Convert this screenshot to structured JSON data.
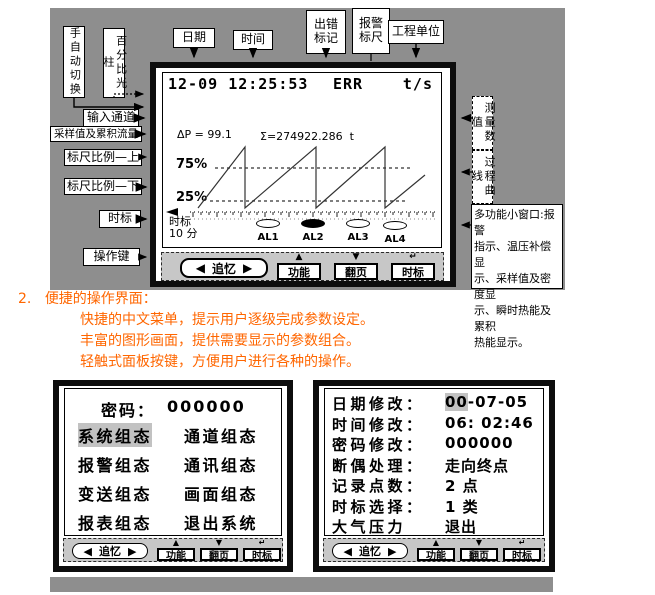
{
  "colors": {
    "panel_gray": "#8e8e8e",
    "keybar_gray": "#c7c7c7",
    "highlight_gray": "#c2c2c2",
    "accent_orange": "#ff6600",
    "ink": "#000000"
  },
  "callouts": {
    "manual_auto": "手自动切换",
    "percent_bar": "百分比光柱",
    "date": "日期",
    "time": "时间",
    "error_mark": "出错\n标记",
    "alarm_ruler": "报警\n标尺",
    "eng_unit": "工程单位",
    "input_channel": "输入通道",
    "sample_value": "采样值及累积流量",
    "scale_upper": "标尺比例—上",
    "scale_lower": "标尺比例—下",
    "time_mark": "时标",
    "op_keys": "操作键",
    "measured_value": "测量数值",
    "process_curve": "过程曲线",
    "multi_window_lines": [
      "多功能小窗口:报警",
      "指示、温压补偿显",
      "示、采样值及密度显",
      "示、瞬时热能及累积",
      "热能显示。"
    ]
  },
  "main_screen": {
    "header": {
      "date": "12-09",
      "time": "12:25:53",
      "err": "ERR",
      "unit": "t/s"
    },
    "dp_label": "ΔP = 99.1",
    "sigma_label": "Σ=274922.286",
    "sigma_unit": "t",
    "upper_pct": "75%",
    "lower_pct": "25%",
    "time_mark_label": "时标",
    "time_mark_value": "10 分",
    "alarms": [
      {
        "label": "AL1",
        "filled": false,
        "cx": 105,
        "cy": 150
      },
      {
        "label": "AL2",
        "filled": true,
        "cx": 150,
        "cy": 150
      },
      {
        "label": "AL3",
        "filled": false,
        "cx": 195,
        "cy": 150
      },
      {
        "label": "AL4",
        "filled": false,
        "cx": 232,
        "cy": 152
      }
    ],
    "waveform": {
      "points": [
        [
          35,
          135
        ],
        [
          82,
          74
        ],
        [
          82,
          135
        ],
        [
          153,
          74
        ],
        [
          153,
          135
        ],
        [
          222,
          74
        ],
        [
          222,
          135
        ],
        [
          262,
          102
        ]
      ],
      "upper_line": {
        "y": 95,
        "x1": 52,
        "x2": 247
      },
      "lower_line": {
        "y": 128,
        "x1": 47,
        "x2": 243
      },
      "axis": {
        "y": 139,
        "x1": 27,
        "x2": 274,
        "tick_step": 8,
        "tick_h": 5
      }
    }
  },
  "keybar": {
    "recall_left": "◀",
    "recall_label": "追忆",
    "recall_right": "▶",
    "keys": [
      {
        "glyph": "▲",
        "label": "功能"
      },
      {
        "glyph": "▼",
        "label": "翻页"
      },
      {
        "glyph": "↵",
        "label": "时标"
      }
    ]
  },
  "section": {
    "number": "2.",
    "title": "便捷的操作界面：",
    "lines": [
      "快捷的中文菜单，提示用户逐级完成参数设定。",
      "丰富的图形画面，提供需要显示的参数组合。",
      "轻触式面板按键，方便用户进行各种的操作。"
    ]
  },
  "menu_screen": {
    "password_label": "密码：",
    "password_value": "000000",
    "highlight": "系统组态",
    "items": [
      {
        "left": "系统组态",
        "right": "通道组态"
      },
      {
        "left": "报警组态",
        "right": "通讯组态"
      },
      {
        "left": "变送组态",
        "right": "画面组态"
      },
      {
        "left": "报表组态",
        "right": "退出系统"
      }
    ]
  },
  "config_screen": {
    "rows": [
      {
        "label": "日期修改：",
        "value_hl": "00",
        "value": "-07-05"
      },
      {
        "label": "时间修改：",
        "value_hl": "",
        "value": "06: 02:46"
      },
      {
        "label": "密码修改：",
        "value_hl": "",
        "value": "000000"
      },
      {
        "label": "断偶处理：",
        "value_hl": "",
        "value": "走向终点"
      },
      {
        "label": "记录点数：",
        "value_hl": "",
        "value": "2 点"
      },
      {
        "label": "时标选择：",
        "value_hl": "",
        "value": "1 类"
      },
      {
        "label": "大气压力",
        "value_hl": "",
        "value": "退出"
      }
    ]
  }
}
